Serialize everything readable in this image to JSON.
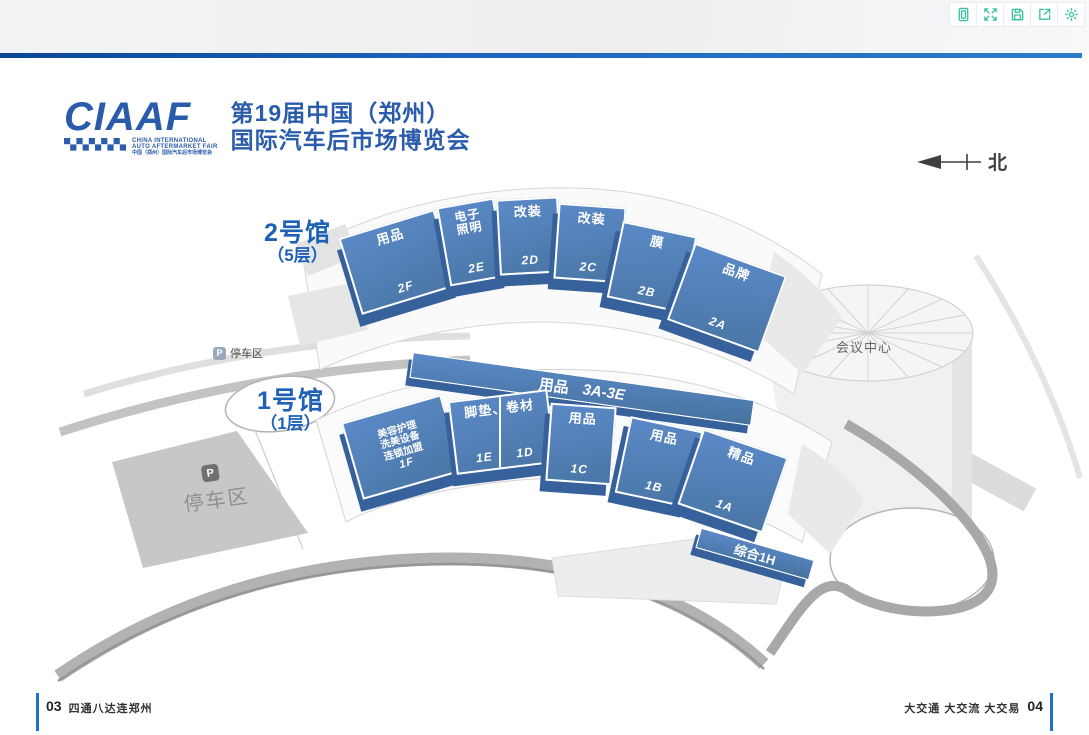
{
  "header": {
    "title": "总体布局图"
  },
  "toolbar": {
    "icons": [
      "reader",
      "fullscreen",
      "save",
      "share",
      "settings"
    ]
  },
  "logo": {
    "wordmark": "CIAAF",
    "en_line1": "CHINA INTERNATIONAL",
    "en_line2": "AUTO AFTERMARKET FAIR",
    "cn_line": "中国（郑州）国际汽车后市场博览会",
    "title_line1": "第19届中国（郑州）",
    "title_line2": "国际汽车后市场博览会"
  },
  "compass": {
    "label": "北"
  },
  "map": {
    "hall2": {
      "label": "2号馆",
      "floor": "（5层）",
      "sections": [
        {
          "name": "用品",
          "code": "2F"
        },
        {
          "line1": "电子",
          "line2": "照明",
          "code": "2E"
        },
        {
          "name": "改装",
          "code": "2D"
        },
        {
          "name": "改装",
          "code": "2C"
        },
        {
          "name": "膜",
          "code": "2B"
        },
        {
          "name": "品牌",
          "code": "2A"
        }
      ]
    },
    "strip3": {
      "name": "用品",
      "code": "3A-3E"
    },
    "hall1": {
      "label": "1号馆",
      "floor": "（1层）",
      "sections": [
        {
          "line1": "美容护理",
          "line2": "洗美设备",
          "line3": "连锁加盟",
          "code": "1F"
        },
        {
          "name": "脚垫、卷材",
          "code_left": "1E",
          "code_right": "1D"
        },
        {
          "name": "用品",
          "code": "1C"
        },
        {
          "name": "用品",
          "code": "1B"
        },
        {
          "name": "精品",
          "code": "1A"
        }
      ]
    },
    "strip1h": {
      "label": "综合1H"
    },
    "conference": {
      "label": "会议中心"
    },
    "parking_road": {
      "badge": "P",
      "label": "停车区"
    },
    "parking_lot": {
      "badge": "P",
      "label": "停车区"
    }
  },
  "footer": {
    "page_left": "03",
    "slogan_left": "四通八达连郑州",
    "slogan_right": "大交通 大交流 大交易",
    "page_right": "04"
  },
  "colors": {
    "accent_blue": "#1565b4",
    "logo_blue": "#2a5cab",
    "block_blue": "#4c7dbd",
    "block_side_blue": "#36619b",
    "icon_teal": "#35c3a0",
    "footer_blue": "#1a73c9"
  }
}
